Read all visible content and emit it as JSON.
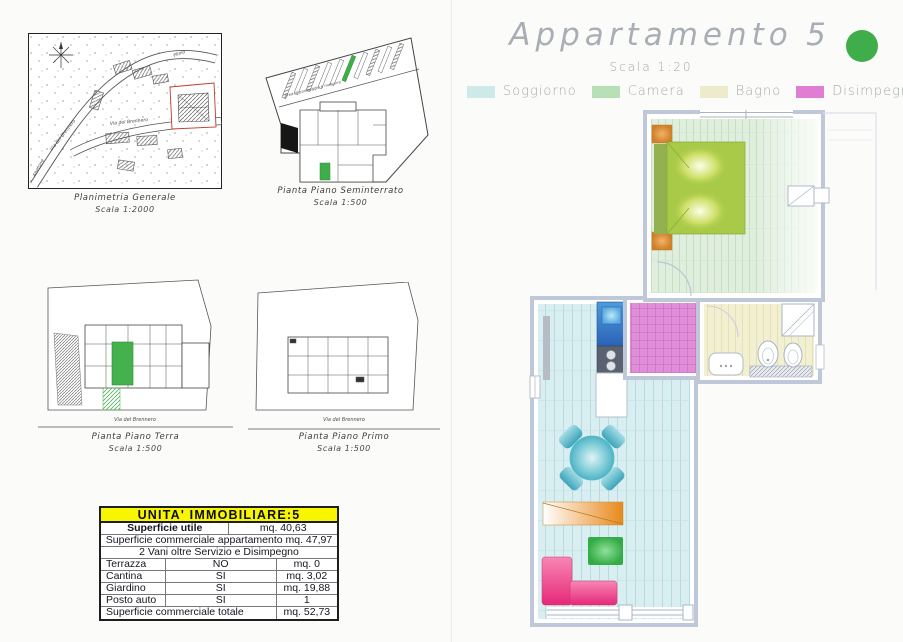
{
  "header": {
    "title": "Appartamento",
    "unit_number": "5",
    "scale": "Scala 1:20",
    "dot_color": "#3fae4a"
  },
  "legend": {
    "items": [
      {
        "label": "Soggiorno",
        "color": "#cde9e8"
      },
      {
        "label": "Camera",
        "color": "#b8e0b6"
      },
      {
        "label": "Bagno",
        "color": "#edebcb"
      },
      {
        "label": "Disimpegno",
        "color": "#e07ed4"
      }
    ]
  },
  "drawings": {
    "planimetria": {
      "caption": "Planimetria Generale",
      "scale": "Scala 1:2000",
      "labels": {
        "brennero_diag": "Via del Brennero",
        "brennero_horiz": "Via del Brennero",
        "plinio": "Plinio",
        "abetone": "Abetone"
      }
    },
    "seminterrato": {
      "caption": "Pianta Piano Seminterrato",
      "scale": "Scala 1:500",
      "note": "Area di parcheggio e manovra"
    },
    "terra": {
      "caption": "Pianta Piano Terra",
      "scale": "Scala 1:500",
      "street": "Via del Brennero"
    },
    "primo": {
      "caption": "Pianta Piano Primo",
      "scale": "Scala 1:500",
      "street": "Via del Brennero"
    }
  },
  "table": {
    "title": "UNITA'  IMMOBILIARE:5",
    "superficie_utile": {
      "label": "Superficie utile",
      "value": "mq.  40,63"
    },
    "commerciale": "Superficie commerciale appartamento  mq.  47,97",
    "vani": "2 Vani oltre Servizio e Disimpegno",
    "items": [
      {
        "label": "Terrazza",
        "flag": "NO",
        "value": "mq.  0"
      },
      {
        "label": "Cantina",
        "flag": "SI",
        "value": "mq.  3,02"
      },
      {
        "label": "Giardino",
        "flag": "SI",
        "value": "mq.  19,88"
      },
      {
        "label": "Posto auto",
        "flag": "SI",
        "value": "1"
      }
    ],
    "totale": {
      "label": "Superficie commerciale totale",
      "value": "mq.  52,73"
    }
  }
}
